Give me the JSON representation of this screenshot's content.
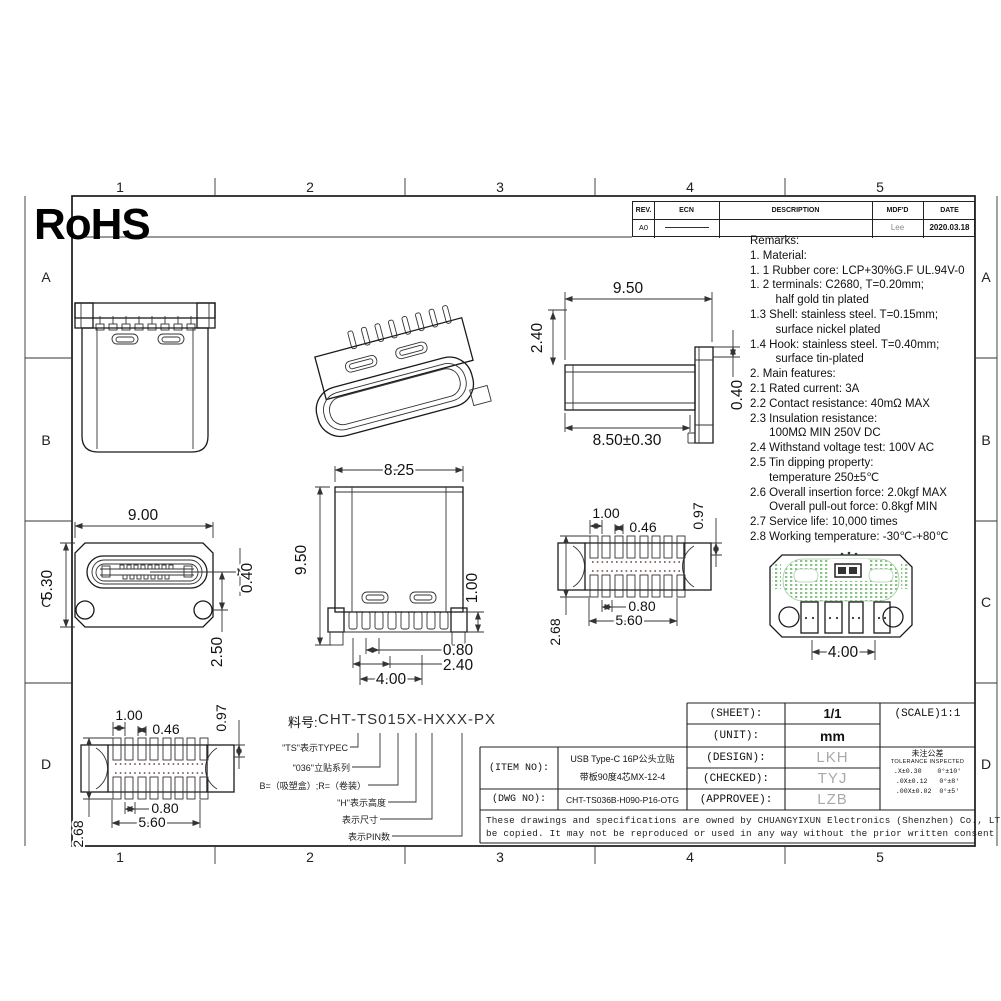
{
  "border": {
    "cols": [
      "1",
      "2",
      "3",
      "4",
      "5"
    ],
    "rows": [
      "A",
      "B",
      "C",
      "D"
    ]
  },
  "logo": {
    "text": "RoHS"
  },
  "rev_table": {
    "headers": [
      "REV.",
      "ECN",
      "DESCRIPTION",
      "MDF'D",
      "DATE"
    ],
    "row": {
      "rev": "A0",
      "mdfd": "Lee",
      "date": "2020.03.18"
    }
  },
  "remarks": {
    "lines": [
      "Remarks:",
      "1. Material:",
      "1. 1 Rubber core: LCP+30%G.F UL.94V-0",
      "1. 2 terminals: C2680, T=0.20mm;",
      "        half gold tin plated",
      "1.3 Shell: stainless steel. T=0.15mm;",
      "        surface nickel plated",
      "1.4 Hook: stainless steel. T=0.40mm;",
      "        surface tin-plated",
      "2. Main features:",
      "2.1 Rated current: 3A",
      "2.2 Contact resistance: 40mΩ MAX",
      "2.3 Insulation resistance:",
      "      100MΩ MIN 250V DC",
      "2.4 Withstand voltage test: 100V AC",
      "2.5 Tin dipping property:",
      "      temperature 250±5℃",
      "2.6 Overall insertion force: 2.0kgf MAX",
      "      Overall pull-out force: 0.8kgf MIN",
      "2.7 Service life: 10,000 times",
      "2.8 Working temperature: -30℃-+80℃"
    ]
  },
  "dims": {
    "side_view": {
      "width": "9.50",
      "height": "2.40",
      "body_len": "8.50±0.30",
      "hook": "0.40"
    },
    "front_view": {
      "width": "9.00",
      "height": "5.30",
      "tongue": "0.40",
      "hole": "2.50"
    },
    "elevation": {
      "width": "8.25",
      "height": "9.50",
      "pin": "1.00",
      "pitch_a": "0.80",
      "pitch_b": "2.40",
      "span": "4.00"
    },
    "footprint": {
      "pitch": "1.00",
      "pad": "0.46",
      "end": "0.97",
      "pitch_b": "0.80",
      "span": "5.60",
      "height": "2.68"
    },
    "pcb": {
      "span": "4.00"
    }
  },
  "part_number": {
    "label": "料号:",
    "code": "CHT-TS015X-HXXX-PX",
    "annotations": [
      "\"TS\"表示TYPEC",
      "\"036\"立贴系列",
      "B=（吸塑盒）;R=（卷装）",
      "\"H\"表示高度",
      "表示尺寸",
      "表示PIN数"
    ]
  },
  "title_block": {
    "sheet_label": "(SHEET):",
    "sheet_value": "1/1",
    "scale_label": "(SCALE)1:1",
    "unit_label": "(UNIT):",
    "unit_value": "mm",
    "design_label": "(DESIGN):",
    "design_value": "LKH",
    "checked_label": "(CHECKED):",
    "checked_value": "TYJ",
    "approvee_label": "(APPROVEE):",
    "approvee_value": "LZB",
    "item_no_label": "(ITEM NO):",
    "item_no_line1": "USB Type-C 16P公头立贴",
    "item_no_line2": "带板90度4芯MX-12-4",
    "dwg_no_label": "(DWG NO):",
    "dwg_no_value": "CHT-TS036B-H090-P16-OTG",
    "tolerance": {
      "title_cn": "未注公差",
      "title_en": "TOLERANCE INSPECTED",
      "row1": ".X±0.30    0°±10′",
      "row2": ".0X±0.12   0°±8′",
      "row3": ".00X±0.02  0°±5′"
    }
  },
  "note": {
    "line1": "These drawings and specifications are owned by CHUANGYIXUN Electronics (Shenzhen) Co., LTD., and shall not",
    "line2": "be copied. It may not be reproduced or used in any way without the prior written consent of our company ."
  },
  "colors": {
    "pad_green": "#86c586",
    "signature_gray": "#a9a9a9",
    "line_black": "#1a1a1a"
  }
}
